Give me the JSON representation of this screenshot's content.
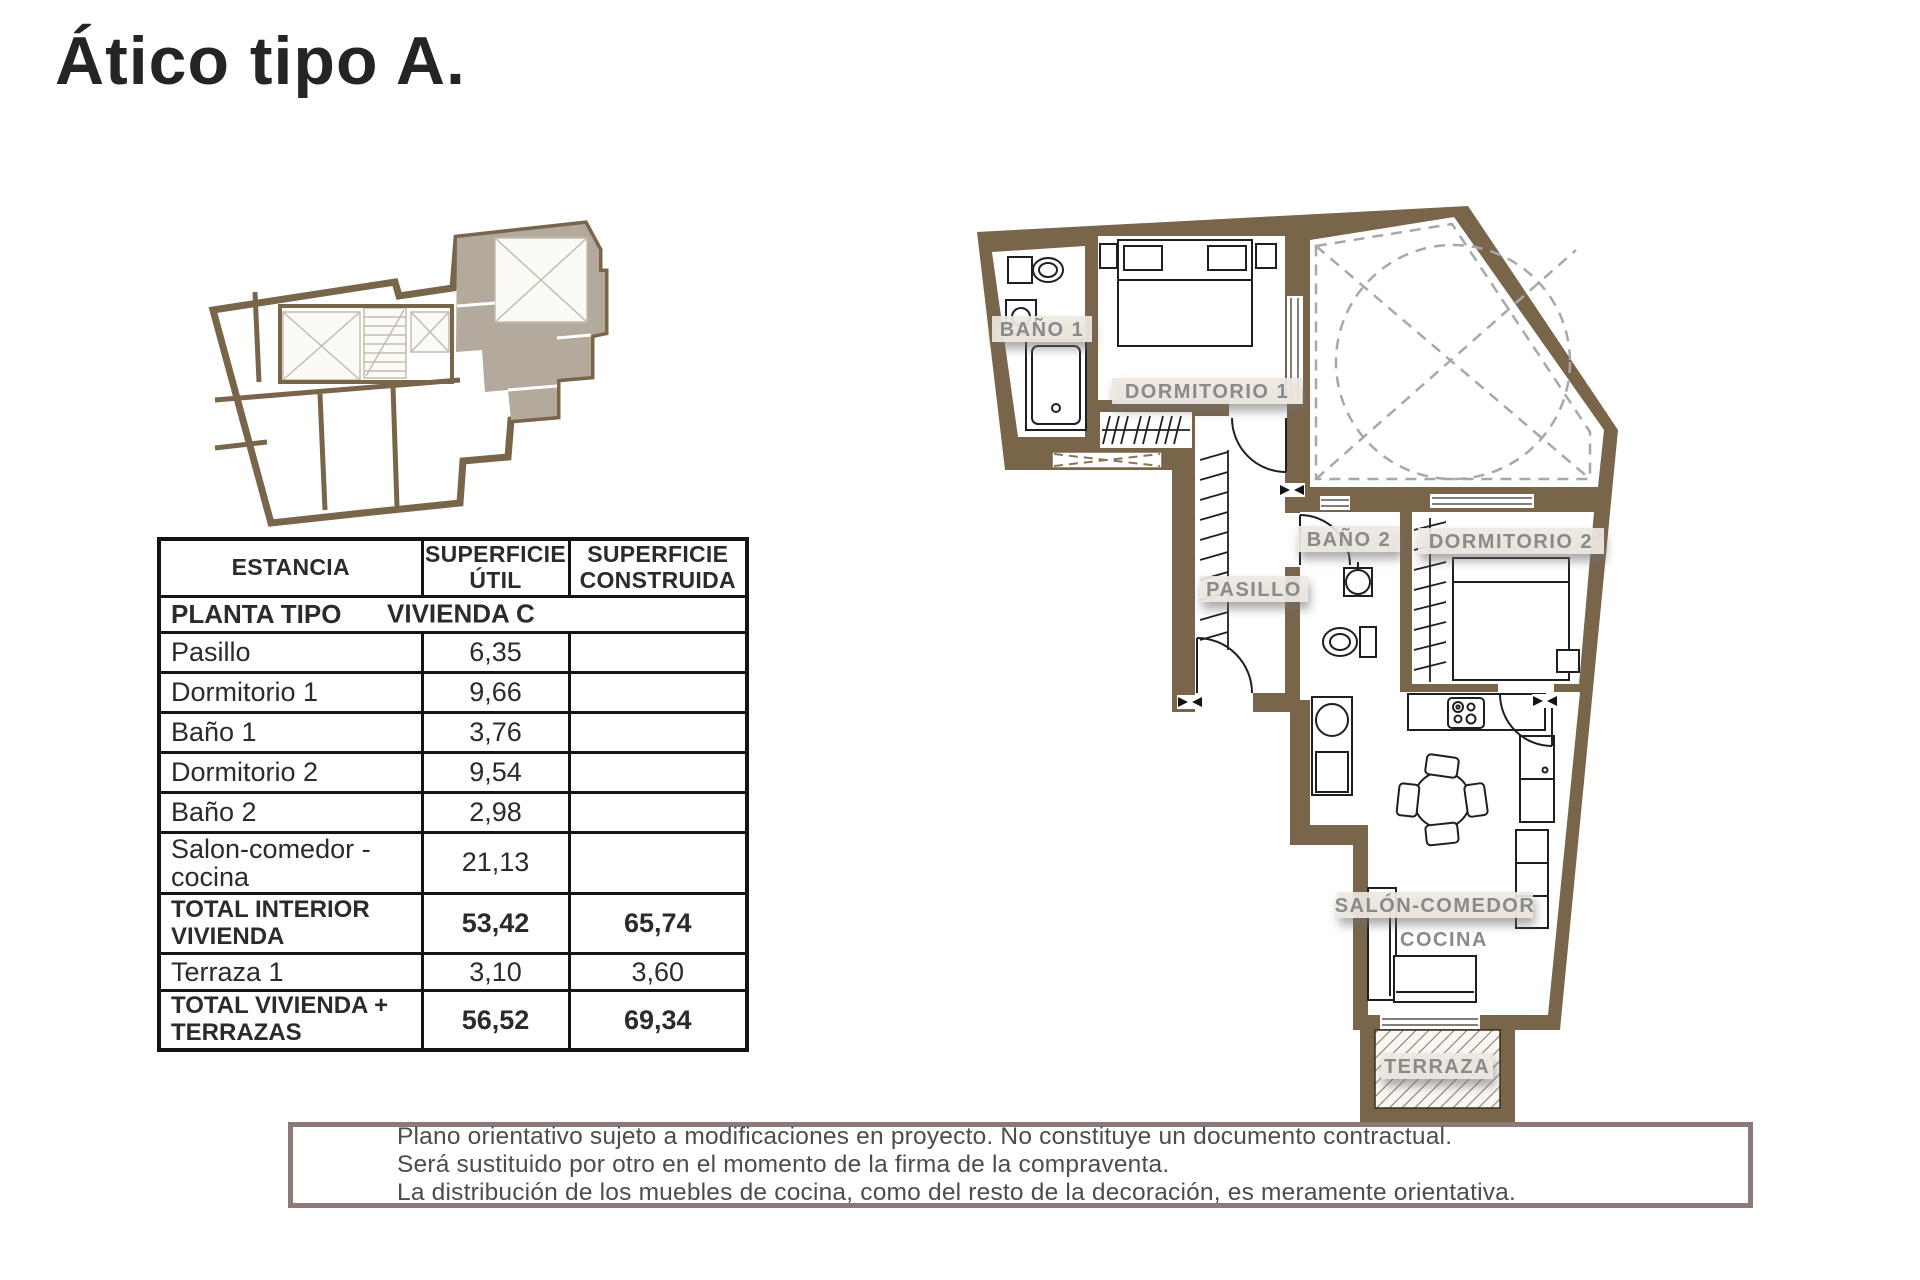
{
  "title": "Ático tipo A.",
  "table": {
    "headers": {
      "col1": "ESTANCIA",
      "col2": "SUPERFICIE ÚTIL",
      "col3": "SUPERFICIE CONSTRUIDA"
    },
    "section_left": "PLANTA TIPO",
    "section_right": "VIVIENDA C",
    "rows": [
      {
        "name": "Pasillo",
        "util": "6,35",
        "construida": ""
      },
      {
        "name": "Dormitorio 1",
        "util": "9,66",
        "construida": ""
      },
      {
        "name": "Baño 1",
        "util": "3,76",
        "construida": ""
      },
      {
        "name": "Dormitorio 2",
        "util": "9,54",
        "construida": ""
      },
      {
        "name": "Baño 2",
        "util": "2,98",
        "construida": ""
      },
      {
        "name": "Salon-comedor - cocina",
        "util": "21,13",
        "construida": ""
      }
    ],
    "totals": [
      {
        "name": "TOTAL INTERIOR VIVIENDA",
        "util": "53,42",
        "construida": "65,74"
      },
      {
        "name": "Terraza 1",
        "util": "3,10",
        "construida": "3,60"
      },
      {
        "name": "TOTAL VIVIENDA + TERRAZAS",
        "util": "56,52",
        "construida": "69,34"
      }
    ]
  },
  "floorplan": {
    "labels": {
      "bano1": "BAÑO 1",
      "dormitorio1": "DORMITORIO 1",
      "pasillo": "PASILLO",
      "bano2": "BAÑO 2",
      "dormitorio2": "DORMITORIO 2",
      "salon_line1": "SALÓN-COMEDOR",
      "salon_line2": "COCINA",
      "terraza": "TERRAZA"
    }
  },
  "disclaimer": {
    "line1": "Plano orientativo sujeto a modificaciones en proyecto. No constituye un documento contractual.",
    "line2": "Será sustituido por otro en el momento de la firma de la compraventa.",
    "line3": "La distribución de los muebles de cocina, como del resto de la decoración, es meramente orientativa."
  },
  "colors": {
    "wall_brown": "#79654a",
    "unit_shade": "#b3a99c",
    "label_gray": "#8a8a8a",
    "table_border": "#141414",
    "disclaimer_border": "#8d7a78"
  }
}
